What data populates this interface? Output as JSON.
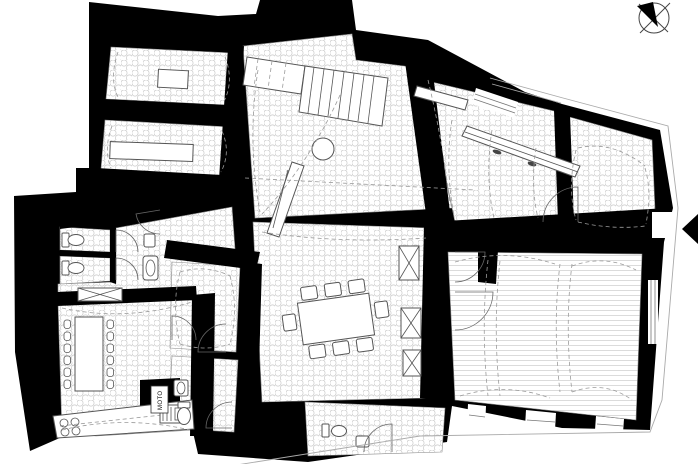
{
  "page": {
    "background": "#ffffff"
  },
  "plan": {
    "labels": {
      "utility_box": "MOTO"
    },
    "colors": {
      "wall": "#000000",
      "floor": "#ffffff",
      "tile": "#c9c9c9",
      "plank": "#d2d2d2",
      "line": "#555555",
      "dash": "#9b9b9b",
      "boundary": "#aaaaaa"
    },
    "symbols": [
      {
        "name": "north-arrow-icon"
      },
      {
        "name": "entrance-arrow-icon"
      }
    ]
  }
}
